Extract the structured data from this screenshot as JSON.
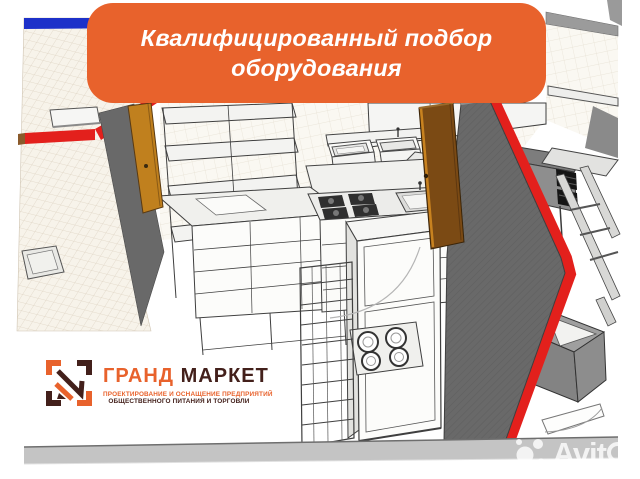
{
  "banner": {
    "line1": "Квалифицированный подбор",
    "line2": "оборудования"
  },
  "logo": {
    "title_part1": "ГРАНД",
    "title_part2": " МАРКЕТ",
    "subtitle_line1": "ПРОЕКТИРОВАНИЕ И ОСНАЩЕНИЕ ПРЕДПРИЯТИЙ",
    "subtitle_line2": "ОБЩЕСТВЕННОГО ПИТАНИЯ И ТОРГОВЛИ"
  },
  "watermark": {
    "text_solid": "Avit",
    "text_outline_letter": "o"
  },
  "icons": {
    "logo_mark": "framed-monogram-icon",
    "avito_dots": "four-circles-icon"
  },
  "colors": {
    "accent_orange": "#E8622C",
    "brand_dark": "#43201B",
    "stripe_blue": "#1D31C9",
    "stripe_red": "#E3201C",
    "wall_gray": "#696969",
    "door_brown": "#7B4A14",
    "door_orange": "#C0801E",
    "floor_strip": "#C4C4C4"
  }
}
